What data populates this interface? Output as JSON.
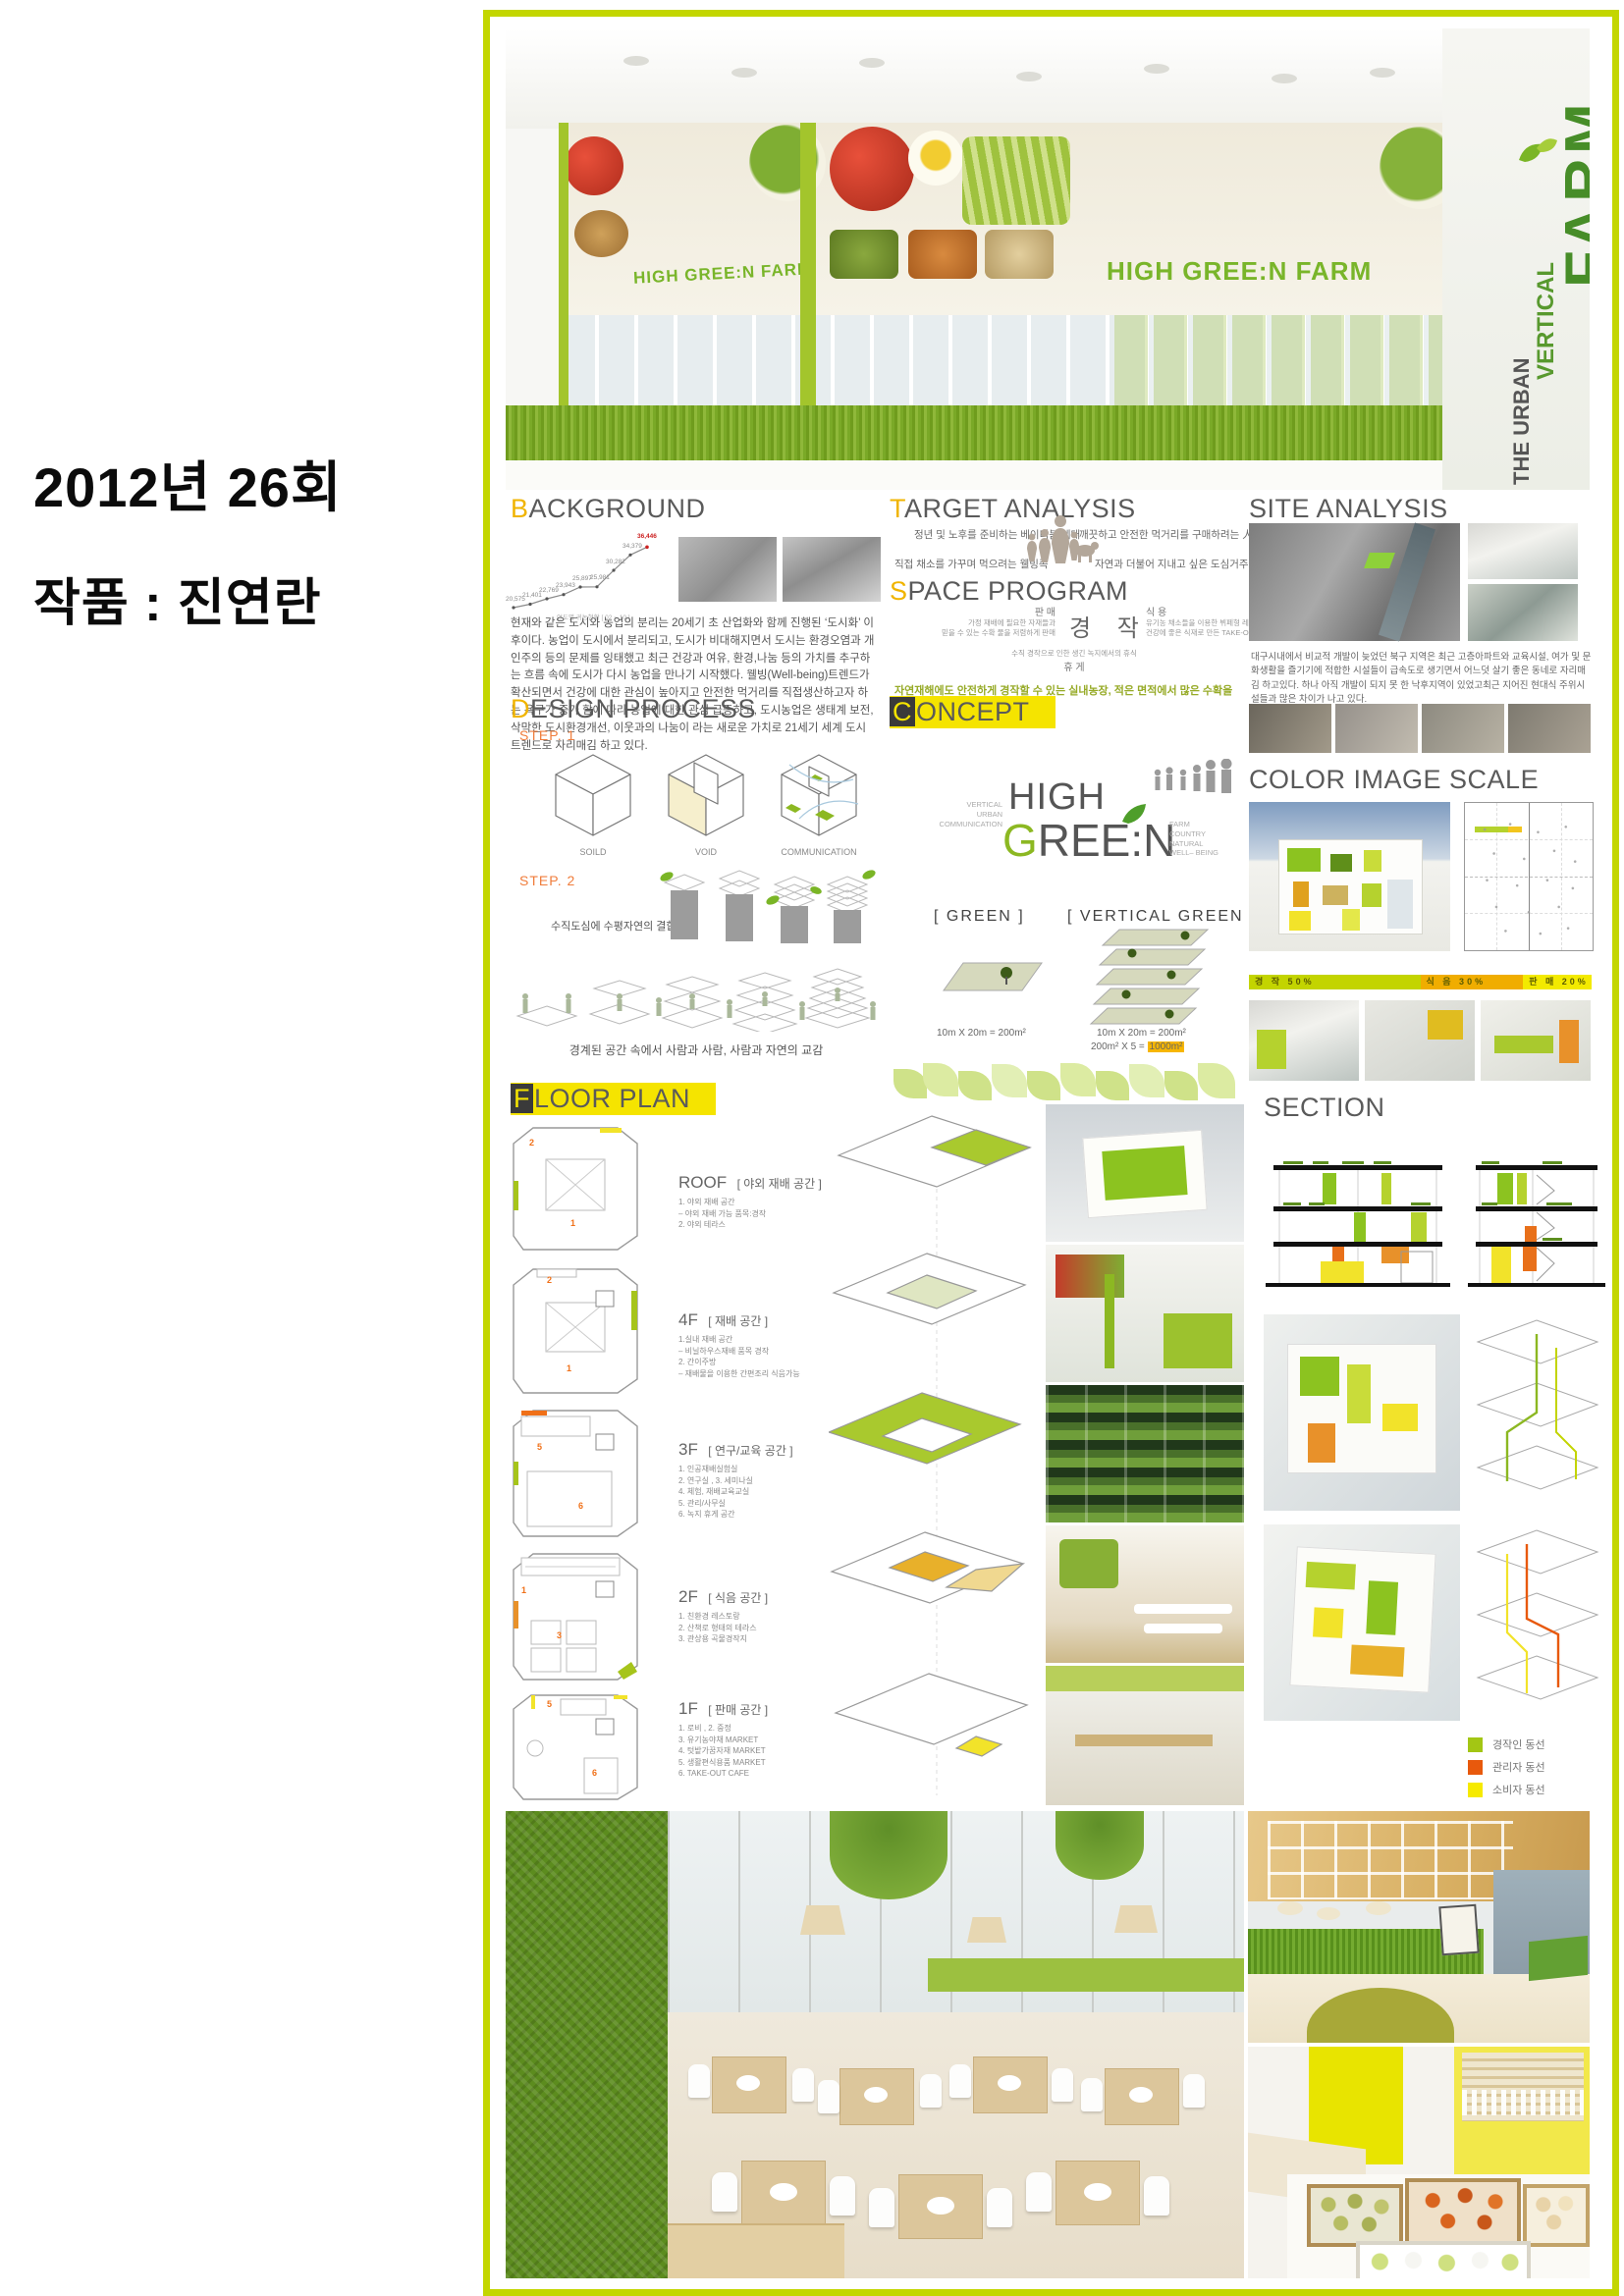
{
  "page": {
    "event_line": "2012년 26회",
    "work_line": "작품 : 진연란"
  },
  "branding": {
    "urban": "THE URBAN",
    "vertical": "VERTICAL",
    "farm": "FARM",
    "banner": "HIGH GREE:N FARM"
  },
  "background": {
    "title_first": "B",
    "title_rest": "ACKGROUND",
    "chart_caption": "연도별 귀농현황 [ 02 ~ 10 ]",
    "labels": [
      "20,575",
      "21,401",
      "22,769",
      "23,943",
      "25,897",
      "25,981",
      "30,282",
      "34,379",
      "36,446"
    ],
    "body": "현재와 같은 도시와 농업의 분리는 20세기 초 산업화와 함께 진행된 ‘도시화’ 이후이다. 농업이 도시에서 분리되고, 도시가 비대해지면서 도시는 환경오염과 개인주의 등의 문제를 잉태했고 최근 건강과 여유, 환경,나눔 등의 가치를 추구하는 흐름 속에 도시가 다시 농업을 만나기 시작했다. 웰빙(Well-being)트렌드가 확산되면서 건강에 대한 관심이 높아지고 안전한 먹거리를 직접생산하고자 하는 욕구가 증가 함에 따라 농업에 대한 관심 급증하고, 도시농업은 생태계 보전, 삭막한 도시환경개선, 이웃과의 나눔이 라는 새로운 가치로 21세기  세계 도시 트렌드로 자리매김 하고 있다."
  },
  "target": {
    "title_first": "T",
    "title_rest": "ARGET ANALYSIS",
    "item1": "정년 및 노후를 준비하는 베이비붐 세대",
    "item2": "직접 채소를 가꾸며 먹으려는 웰빙족",
    "item3": "깨끗하고 안전한 먹거리를 구매하려는 人",
    "item4": "자연과 더불어 지내고 싶은 도심거주민"
  },
  "space": {
    "title_first": "S",
    "title_rest": "PACE PROGRAM",
    "sale_title": "판 매",
    "sale_desc": "가정 재배에 필요한 자재들과\n믿을 수 있는 수확 물을 저렴하게 판매",
    "center": "경 작",
    "food_title": "식 용",
    "food_desc": "유기농 채소들을 이용한 뷔페형 레스토랑 운영\n건강에 좋은 식재로 만든 TAKE-OUT 카페운영",
    "rest_desc": "수직 경작으로 인한 생긴 녹지에서의 휴식",
    "rest_title": "휴 게",
    "highlight": "자연재해에도 안전하게 경작할 수 있는 실내농장, 적은 면적에서 많은 수확을 위한 효율적 경작"
  },
  "site": {
    "title": "SITE ANALYSIS",
    "body": "대구시내에서 비교적 개발이 늦었던 북구 지역은 최근 고층아파트와 교육시설, 여가 및 문화생활을 즐기기에 적합한 시설들이 급속도로 생기면서 어느덧 살기 좋은 동네로 자리매김 하고있다. 하나 아직 개발이 되지 못 한 낙후지역이 있었고최근 지어진 현대식 주위시설들과 많은 차이가 나고 있다."
  },
  "design": {
    "title_first": "D",
    "title_rest": "ESIGN PROCESS",
    "step1": "STEP. 1",
    "step2": "STEP. 2",
    "cube1": "SOILD",
    "cube2": "VOID",
    "cube3": "COMMUNICATION",
    "caption1": "수직도심에 수평자연의 결합",
    "caption2": "경계된 공간 속에서 사람과 사람, 사람과 자연의 교감"
  },
  "concept": {
    "title_first": "C",
    "title_rest": "ONCEPT",
    "left_words": "VERTICAL\nURBAN\nCOMMUNICATION",
    "high": "HIGH",
    "g": "G",
    "ree": "REE",
    "colon": ":",
    "n": "N",
    "right_words": "FARM\nCOUNTRY\nNATURAL\nWELL– BEING",
    "green_label": "[ GREEN ]",
    "vgreen_label": "[ VERTICAL GREEN ]",
    "green_area": "10m X 20m = 200m²",
    "vgreen_area1": "10m X 20m = 200m²",
    "vgreen_area2": "200m² X 5 =",
    "vgreen_total": "1000m²"
  },
  "colorscale": {
    "title": "COLOR IMAGE SCALE",
    "bar": [
      {
        "label": "경 작 50%",
        "color": "#c3d400"
      },
      {
        "label": "식 음 30%",
        "color": "#f0ad00"
      },
      {
        "label": "판 매 20%",
        "color": "#f3ea00"
      }
    ]
  },
  "floorplan": {
    "title_first": "F",
    "title_rest": "LOOR PLAN",
    "floors": [
      {
        "name": "ROOF",
        "label": "[ 야외 재배 공간 ]",
        "desc": "1. 야외 재배 공간\n– 야외 재배 가능 품목:경작\n2. 야외 테라스",
        "m1": "1",
        "m2": "2"
      },
      {
        "name": "4F",
        "label": "[ 재배 공간 ]",
        "desc": "1.실내 재배 공간\n– 비닐하우스재배 품목 경작\n2. 간이주방\n– 재배물을 이용한 간편조리 식음가능",
        "m1": "1",
        "m2": "2"
      },
      {
        "name": "3F",
        "label": "[ 연구/교육 공간 ]",
        "desc": "1. 인공재배실험실\n2. 연구실 , 3. 세미나실\n4. 체험, 재배교육교실\n5. 관리/사무실\n6. 녹지 휴게 공간",
        "m1": "6",
        "m2": "5"
      },
      {
        "name": "2F",
        "label": "[ 식음 공간 ]",
        "desc": "1. 친환경 레스토랑\n2. 산책로 형태의 테라스\n3. 관상용 곡물경작지",
        "m1": "3",
        "m2": "1"
      },
      {
        "name": "1F",
        "label": "[ 판매 공간 ]",
        "desc": "1. 로비 , 2. 중정\n3. 유기농야채 MARKET\n4. 텃밭가꿈자재 MARKET\n5. 생활편식용품 MARKET\n6. TAKE-OUT CAFE",
        "m1": "5",
        "m2": "6"
      }
    ]
  },
  "sectiondwg": {
    "title": "SECTION"
  },
  "legend": [
    {
      "label": "경작인 동선",
      "color": "#a3c614"
    },
    {
      "label": "관리자 동선",
      "color": "#e8590c"
    },
    {
      "label": "소비자 동선",
      "color": "#f6ea00"
    }
  ],
  "chart_data": {
    "type": "line",
    "x": [
      "'02",
      "'03",
      "'04",
      "'05",
      "'06",
      "'07",
      "'08",
      "'09",
      "'10"
    ],
    "values": [
      20575,
      21401,
      22769,
      23943,
      25897,
      25981,
      30282,
      34379,
      36446
    ],
    "title": "연도별 귀농현황 [ 02 ~ 10 ]",
    "ylim": [
      20000,
      37500
    ],
    "notes": "returning-to-farm trend line, last value 36,446 highlighted in red"
  }
}
